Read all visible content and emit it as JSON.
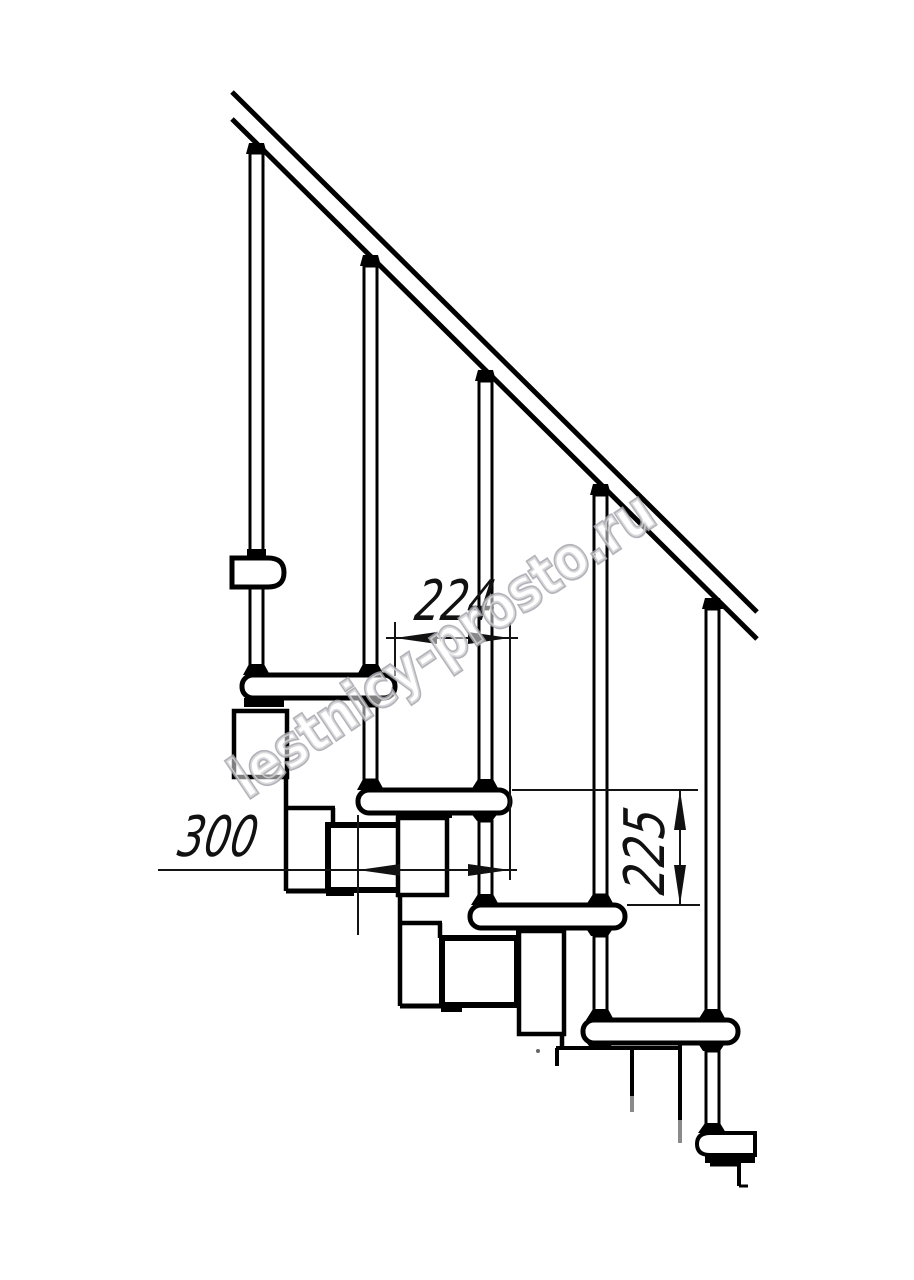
{
  "drawing": {
    "type_label": "Modular staircase side elevation drawing",
    "watermark_text": "lestnicy-prosto.ru",
    "colors": {
      "background": "#ffffff",
      "line": "#000000",
      "dimension_line": "#141414",
      "watermark": "#a6a6ad"
    },
    "dimensions": {
      "step_run": {
        "value": "224"
      },
      "tread_depth": {
        "value": "300"
      },
      "riser_height": {
        "value": "225"
      }
    }
  }
}
